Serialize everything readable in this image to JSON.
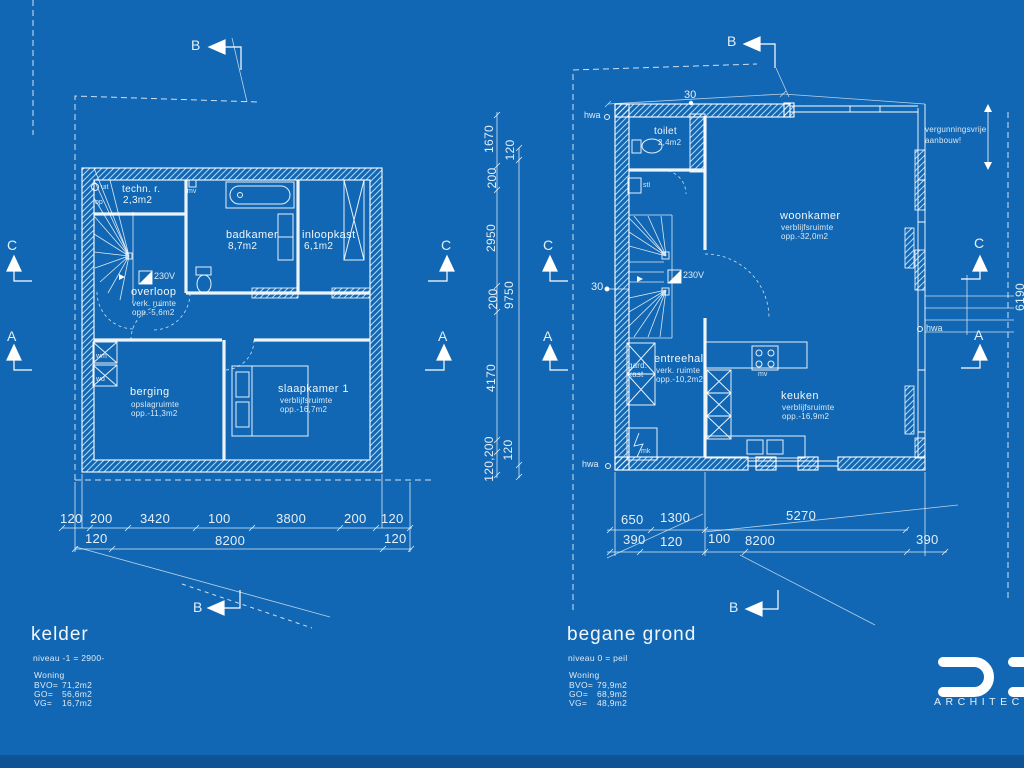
{
  "colors": {
    "background": "#1167b3",
    "line": "#ffffff",
    "footer_band": "#0e5494"
  },
  "markers": {
    "b": "B",
    "c": "C",
    "a": "A"
  },
  "logo": {
    "brand": "ARCHITEC"
  },
  "kelder": {
    "title": "kelder",
    "level": "niveau -1 = 2900-",
    "stats_heading": "Woning",
    "stats": [
      {
        "k": "BVO=",
        "v": "71,2m2"
      },
      {
        "k": "GO=",
        "v": "56,6m2"
      },
      {
        "k": "VG=",
        "v": "16,7m2"
      }
    ],
    "rooms": {
      "techn": {
        "name": "techn. r.",
        "area": "2,3m2"
      },
      "badkamer": {
        "name": "badkamer",
        "area": "8,7m2"
      },
      "inloopkast": {
        "name": "inloopkast",
        "area": "6,1m2"
      },
      "overloop": {
        "name": "overloop",
        "type": "verk. ruimte",
        "area": "opp.-5,6m2"
      },
      "berging": {
        "name": "berging",
        "type": "opslagruimte",
        "area": "opp.-11,3m2"
      },
      "slaapkamer": {
        "name": "slaapkamer 1",
        "type": "verblijfsruimte",
        "area": "opp.-16,7m2"
      }
    },
    "labels": {
      "wm": "wm",
      "wd": "wd",
      "mv": "mv",
      "uit": "uit",
      "op": "op",
      "power": "230V"
    },
    "dims_row1": [
      "120",
      "200",
      "3420",
      "100",
      "3800",
      "200",
      "120"
    ],
    "dims_row2": [
      "120",
      "8200",
      "120"
    ],
    "vdims_inner": [
      "1670",
      "200",
      "2950",
      "200",
      "4170",
      "120,200"
    ],
    "vdims_outer": [
      "120",
      "9750",
      "120"
    ]
  },
  "begane_grond": {
    "title": "begane grond",
    "level": "niveau 0 = peil",
    "stats_heading": "Woning",
    "stats": [
      {
        "k": "BVO=",
        "v": "79,9m2"
      },
      {
        "k": "GO=",
        "v": "68,9m2"
      },
      {
        "k": "VG=",
        "v": "48,9m2"
      }
    ],
    "rooms": {
      "toilet": {
        "name": "toilet",
        "area": "2,4m2"
      },
      "woonkamer": {
        "name": "woonkamer",
        "type": "verblijfsruimte",
        "area": "opp.-32,0m2"
      },
      "entreehal": {
        "name": "entreehal",
        "type": "verk. ruimte",
        "area": "opp.-10,2m2"
      },
      "keuken": {
        "name": "keuken",
        "type": "verblijfsruimte",
        "area": "opp.-16,9m2"
      }
    },
    "labels": {
      "hwa": "hwa",
      "gard": "gard.",
      "kast": "kast",
      "mk": "mk",
      "stl": "stl",
      "mv": "mv",
      "power": "230V",
      "offset_top": "30",
      "offset_left": "30"
    },
    "note_line1": "vergunningsvrije",
    "note_line2": "aanbouw!",
    "dims_row1": [
      "650",
      "1300",
      "5270"
    ],
    "dims_row2": [
      "390",
      "120",
      "100",
      "8200",
      "390"
    ],
    "vdim_right": "6190"
  }
}
